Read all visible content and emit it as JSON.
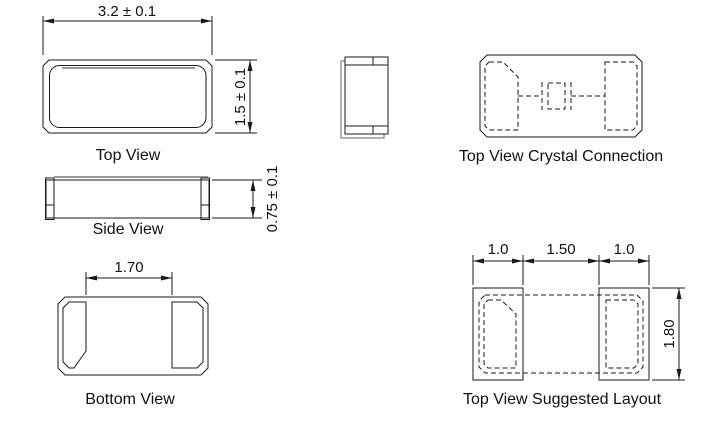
{
  "drawing": {
    "type": "mechanical-drawing",
    "views": {
      "top_view": {
        "label": "Top View",
        "dimensions": {
          "width": "3.2 ± 0.1",
          "height": "1.5 ± 0.1"
        }
      },
      "side_view": {
        "label": "Side View",
        "dimensions": {
          "height": "0.75 ± 0.1"
        }
      },
      "bottom_view": {
        "label": "Bottom View",
        "dimensions": {
          "pad_inner_spacing": "1.70"
        }
      },
      "end_view": {
        "label": ""
      },
      "crystal_connection_view": {
        "label": "Top View Crystal Connection"
      },
      "suggested_layout_view": {
        "label": "Top View Suggested Layout",
        "dimensions": {
          "left_pad_width": "1.0",
          "pad_gap": "1.50",
          "right_pad_width": "1.0",
          "pad_height": "1.80"
        }
      }
    },
    "colors": {
      "line": "#1a1a1a",
      "shadow_line": "#9a9a9a",
      "background": "#ffffff"
    }
  }
}
